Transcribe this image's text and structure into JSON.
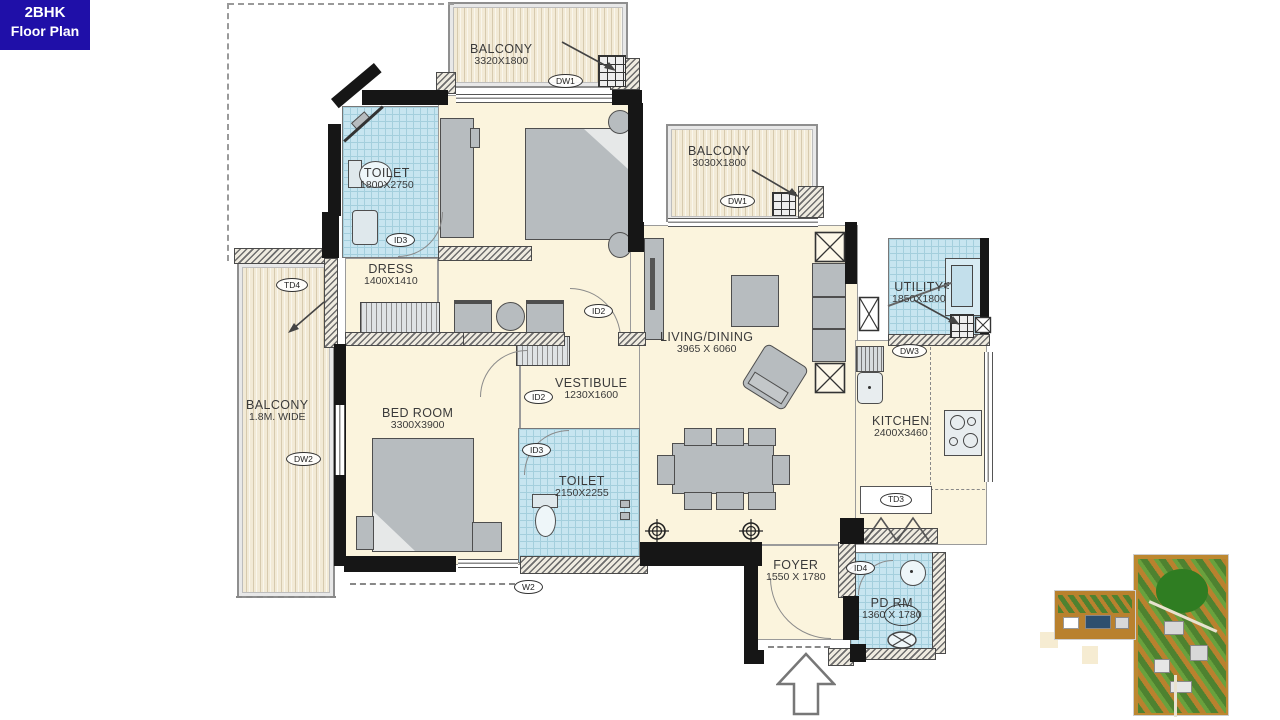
{
  "badge": {
    "title": "2BHK",
    "subtitle": "Floor Plan"
  },
  "rooms": {
    "balcony_top": {
      "label": "BALCONY",
      "dims": "3320X1800",
      "tag": "DW1"
    },
    "balcony_right": {
      "label": "BALCONY",
      "dims": "3030X1800",
      "tag": "DW1"
    },
    "balcony_left": {
      "label": "BALCONY",
      "dims": "1.8M. WIDE",
      "tag": "DW2",
      "tag_top": "TD4"
    },
    "toilet_top": {
      "label": "TOILET",
      "dims": "1800X2750",
      "tag": "ID3"
    },
    "master": {
      "tag": "ID2"
    },
    "dress": {
      "label": "DRESS",
      "dims": "1400X1410"
    },
    "living": {
      "label": "LIVING/DINING",
      "dims": "3965 X 6060"
    },
    "vestibule": {
      "label": "VESTIBULE",
      "dims": "1230X1600",
      "tag": "ID2"
    },
    "bedroom": {
      "label": "BED ROOM",
      "dims": "3300X3900"
    },
    "toilet2": {
      "label": "TOILET",
      "dims": "2150X2255",
      "tag": "ID3",
      "tag_below": "W2"
    },
    "utility": {
      "label": "UTILITY",
      "dims": "1850X1800",
      "tag": "DW3"
    },
    "kitchen": {
      "label": "KITCHEN",
      "dims": "2400X3460",
      "tag": "TD3"
    },
    "foyer": {
      "label": "FOYER",
      "dims": "1550 X 1780"
    },
    "pdrm": {
      "label": "PD RM",
      "dims": "1360 X 1780",
      "tag": "ID4"
    }
  },
  "fixtures": {
    "washer": "W"
  },
  "colors": {
    "badge_bg": "#1f0fa8",
    "floor": "#fbf4dd",
    "tile": "#c7e5f0",
    "wood": "#f2ead6",
    "wall": "#161616",
    "furniture": "#b7bcbf"
  }
}
